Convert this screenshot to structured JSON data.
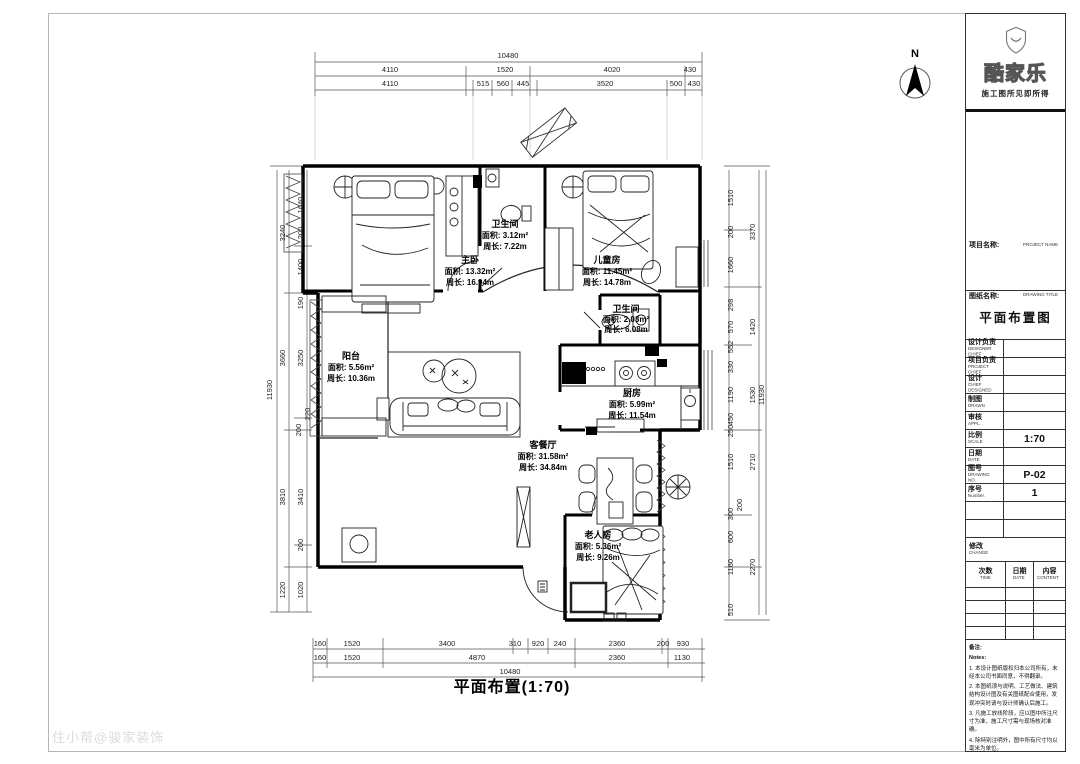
{
  "sheet": {
    "caption": "平面布置(1:70)",
    "watermark": "住小帮@骏家装饰",
    "north": "N"
  },
  "logo": {
    "brand": "酷家乐",
    "tagline": "施工图所见即所得"
  },
  "tb": {
    "project_label": "项目名称:",
    "project_en": "PROJECT NAME",
    "drawing_label": "图纸名称:",
    "drawing_en": "DRAWING TITLE",
    "drawing_title": "平面布置图",
    "rows": [
      {
        "label": "设计负责",
        "en": "DESIGNER CHIEF",
        "value": ""
      },
      {
        "label": "项目负责",
        "en": "PROJECT CHIEF",
        "value": ""
      },
      {
        "label": "设计",
        "en": "CHIEF DESIGNED",
        "value": ""
      },
      {
        "label": "制图",
        "en": "DRAWN",
        "value": ""
      },
      {
        "label": "审核",
        "en": "APPL.",
        "value": ""
      },
      {
        "label": "比例",
        "en": "SCALE",
        "value": "1:70"
      },
      {
        "label": "日期",
        "en": "DATE",
        "value": ""
      },
      {
        "label": "图号",
        "en": "DRAWING NO.",
        "value": "P-02"
      },
      {
        "label": "序号",
        "en": "Number.",
        "value": "1"
      }
    ],
    "change": "修改",
    "change_en": "CHANGE",
    "cols": [
      {
        "label": "次数",
        "en": "TIME"
      },
      {
        "label": "日期",
        "en": "DATE"
      },
      {
        "label": "内容",
        "en": "CONTENT"
      }
    ],
    "notes_label": "备注:",
    "notes_en": "Notes:",
    "notes": [
      "1. 本设计图纸版权归本公司所有，未经本公司书面同意，不得翻录。",
      "2. 本图纸须与说明、工艺做法、建筑结构设计图及有关图纸配合使用，发现冲突时请与设计师确认后施工。",
      "3. 凡施工放线阶段，应以图中所注尺寸为准，施工尺寸需与现场核对准确。",
      "4. 除特别注明外，图中所有尺寸均以毫米为单位。",
      "5. 本图经业主审核签字，图纸生效。"
    ]
  },
  "rooms": {
    "master": {
      "name": "主卧",
      "area": "面积: 13.32m²",
      "perim": "周长: 16.94m"
    },
    "bath1": {
      "name": "卫生间",
      "area": "面积: 3.12m²",
      "perim": "周长: 7.22m"
    },
    "kids": {
      "name": "儿童房",
      "area": "面积: 11.45m²",
      "perim": "周长: 14.78m"
    },
    "bath2": {
      "name": "卫生间",
      "area": "面积: 2.03m²",
      "perim": "周长: 6.08m"
    },
    "balcony": {
      "name": "阳台",
      "area": "面积: 5.56m²",
      "perim": "周长: 10.36m"
    },
    "kitchen": {
      "name": "厨房",
      "area": "面积: 5.99m²",
      "perim": "周长: 11.54m"
    },
    "living": {
      "name": "客餐厅",
      "area": "面积: 31.58m²",
      "perim": "周长: 34.84m"
    },
    "elder": {
      "name": "老人房",
      "area": "面积: 5.36m²",
      "perim": "周长: 9.26m"
    }
  },
  "dims": {
    "top": {
      "total": "10480",
      "row2": [
        "4110",
        "1520",
        "4020",
        "430"
      ],
      "row3": [
        "4110",
        "515",
        "560",
        "445",
        "3520",
        "500",
        "430"
      ]
    },
    "bottom": {
      "total": "10480",
      "row2": [
        "160",
        "1520",
        "4870",
        "2360",
        "1130"
      ],
      "row1": [
        "160",
        "1520",
        "3400",
        "310",
        "920",
        "240",
        "2360",
        "200",
        "930"
      ]
    },
    "left": {
      "total": "11930",
      "mid": [
        "3240",
        "3660",
        "3810",
        "1220"
      ],
      "inner": [
        "1640",
        "200",
        "1400",
        "190",
        "3250",
        "220",
        "200",
        "3410",
        "200",
        "1020"
      ]
    },
    "right": {
      "total": "11930",
      "mid": [
        "3370",
        "1420",
        "1530",
        "2710",
        "2270"
      ],
      "inner": [
        "1510",
        "200",
        "1660",
        "298",
        "570",
        "552",
        "330",
        "1190",
        "450",
        "250",
        "1510",
        "200",
        "300",
        "600",
        "1160",
        "510"
      ]
    }
  }
}
